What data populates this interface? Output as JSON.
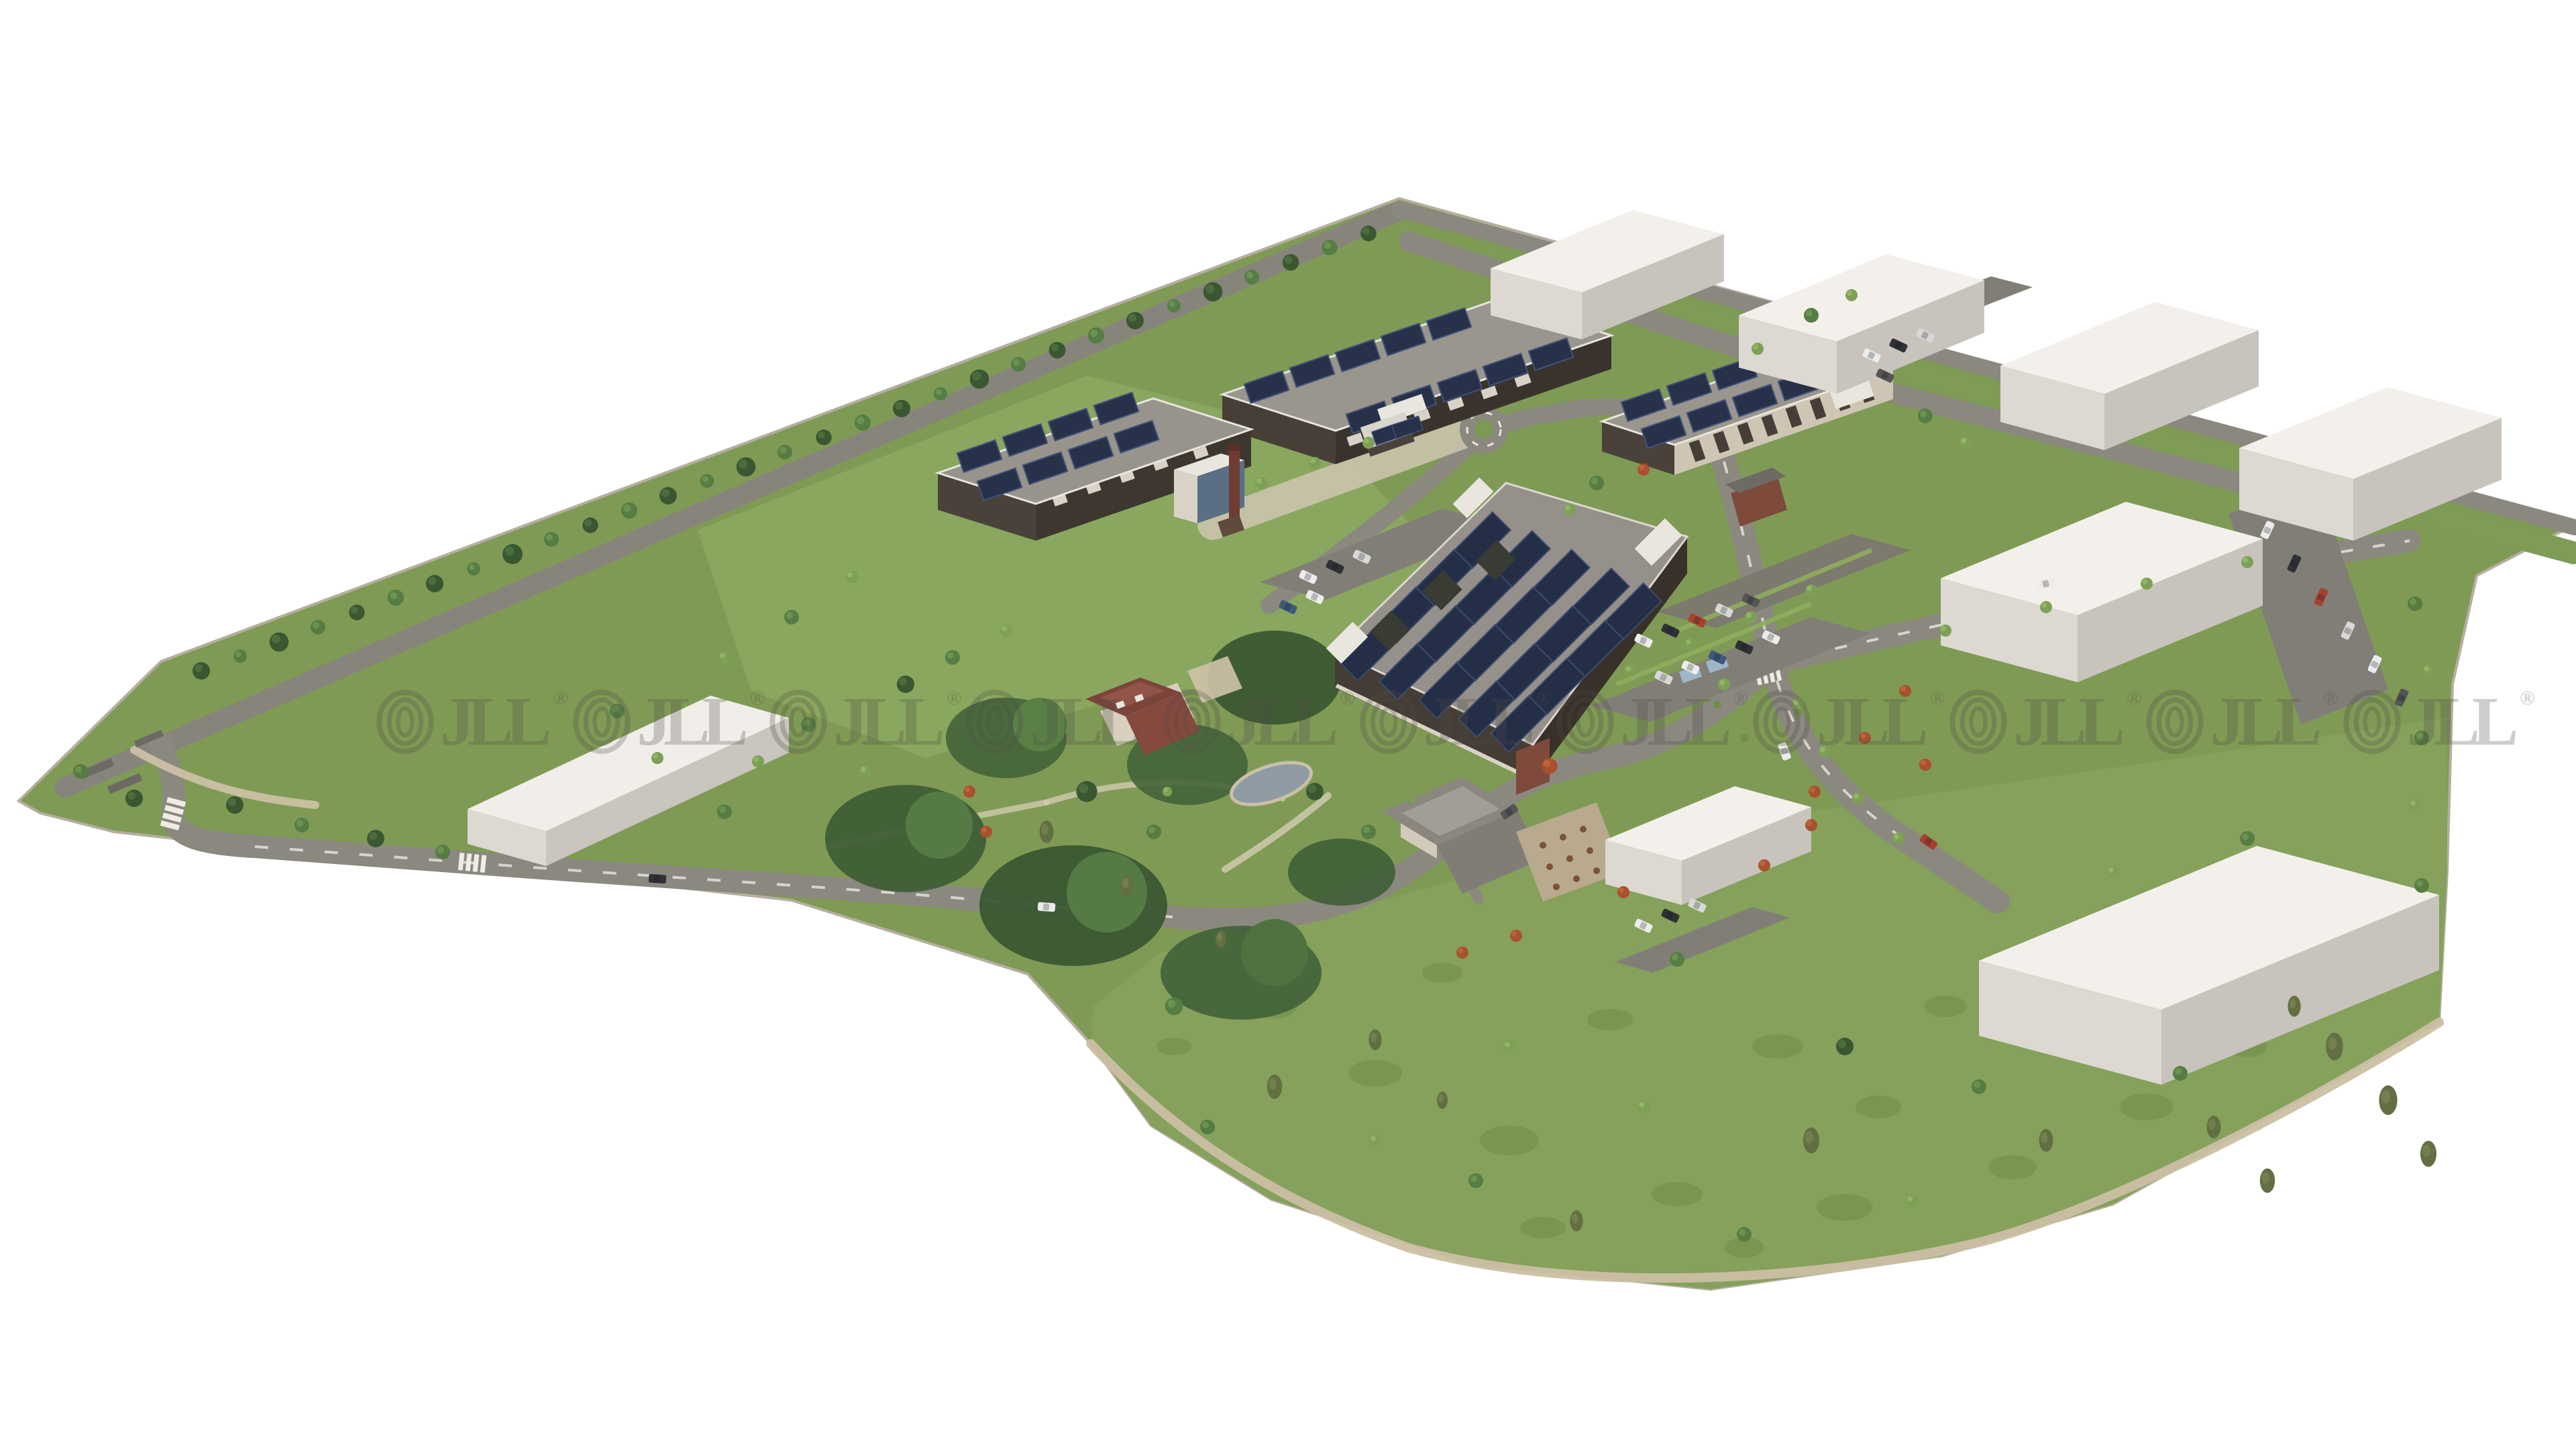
{
  "image_type": "aerial-3d-architectural-render",
  "watermark": {
    "text": "JLL",
    "registered_symbol": "®",
    "repetitions": 11,
    "color": "#514c47",
    "opacity": 0.27
  },
  "scene": {
    "description": "Bird's-eye 3D masterplan rendering of a landscaped business-park campus on a white background: dark-brick buildings with rooftop solar arrays, a large solar-roofed hall, white future-phase massing blocks, tree-lined boundary, internal roads, parking courts, a heritage chimney, a villa with red roof, a pavilion with terrace, a pond and a wildflower meadow",
    "elements": [
      {
        "name": "office-building-a",
        "label": "Two-wing office building with rooftop solar panels"
      },
      {
        "name": "office-building-b",
        "label": "Office building with solar roof and glazed corner tower"
      },
      {
        "name": "solar-warehouse",
        "label": "Large hall fully covered with solar arrays"
      },
      {
        "name": "arcade-building",
        "label": "Long colonnade building with scattered solar panels"
      },
      {
        "name": "heritage-chimney",
        "label": "Red brick industrial chimney"
      },
      {
        "name": "villa",
        "label": "Historic villa with red hipped roof"
      },
      {
        "name": "pavilion-building",
        "label": "Pavilion with grey hipped roof and terrace"
      },
      {
        "name": "brick-house",
        "label": "Small brick gatehouse"
      },
      {
        "name": "future-building-block",
        "label": "White massing volume of a future construction phase"
      },
      {
        "name": "pond",
        "label": "Garden pond"
      },
      {
        "name": "meadow",
        "label": "Meadow with scattered trees"
      },
      {
        "name": "parking-lot",
        "label": "Surface parking court with cars"
      },
      {
        "name": "boundary-tree-row",
        "label": "Tree row along north-west site boundary"
      }
    ]
  },
  "palette": {
    "background": "#ffffff",
    "grass": "#7f9a55",
    "meadow": "#85a15c",
    "road": "#8b8880",
    "parking_asphalt": "#817e77",
    "roof_grey": "#9a958d",
    "solar_panel": "#242e46",
    "dark_facade": "#473f37",
    "brick_red": "#7e4a3c",
    "future_block_top": "#f3f0ec",
    "future_block_side": "#c9c4be",
    "tree_dark": "#3b5732",
    "tree_light": "#7da055",
    "pond": "#8f9aa4",
    "path_tan": "#cfc3a8",
    "watermark_grey": "#514c47"
  }
}
